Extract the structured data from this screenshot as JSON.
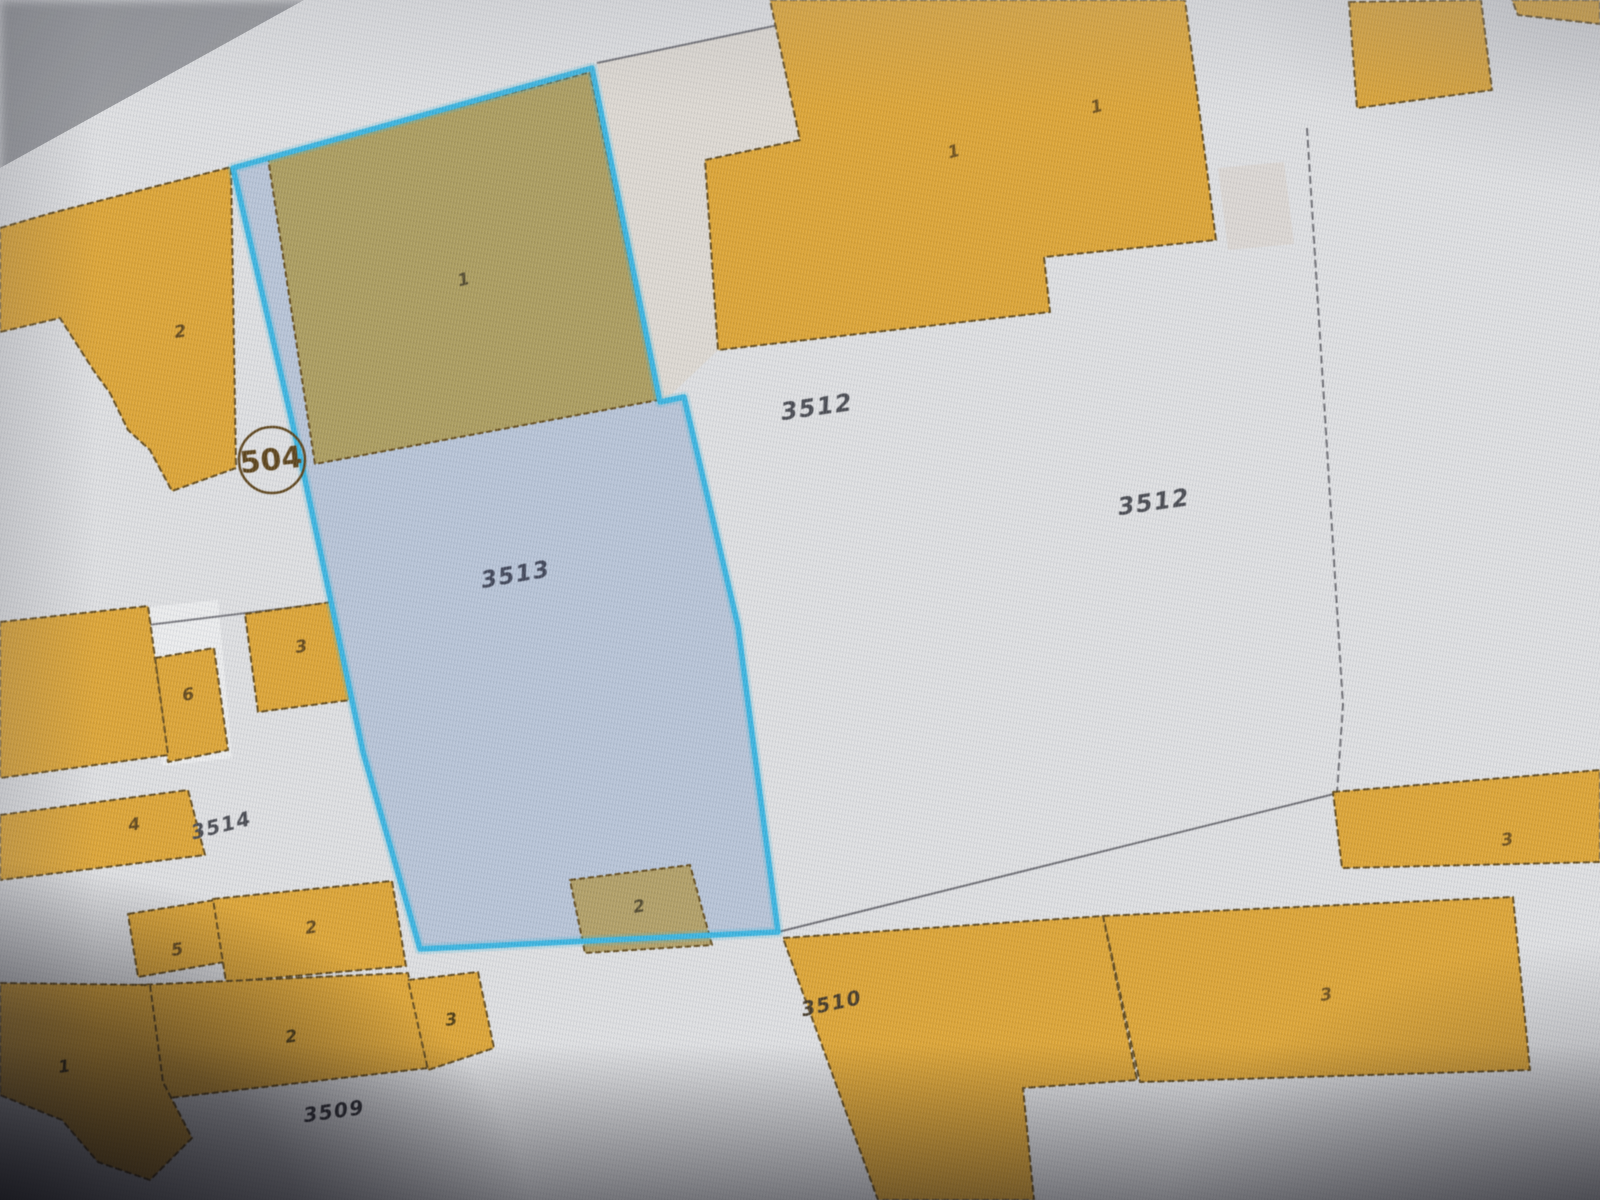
{
  "app": {
    "title": "Cadastral parcel map view",
    "selected_parcel_id": "3513"
  },
  "colors": {
    "screen_background": "#dedfe1",
    "building_orange": "#e0a226",
    "building_outline_brown": "#5f4512",
    "selection_fill_blue": "#b2c1d7",
    "selection_outline_cyan": "#2db5e5",
    "olive_building_under_selection": "#ab9a55",
    "parcel_label_dark": "#43454c",
    "boundary_gray": "#6a6a70"
  },
  "map": {
    "width": 1600,
    "height": 1200,
    "background": "#dedfe1",
    "building_fill": "#e0a226",
    "building_stroke": "#5f4512",
    "regions": [
      {
        "name": "pale-strip-parcel",
        "fill": "#ddd8d0",
        "points": [
          [
            597,
            63
          ],
          [
            788,
            23
          ],
          [
            800,
            140
          ],
          [
            706,
            158
          ],
          [
            718,
            350
          ],
          [
            660,
            405
          ],
          [
            628,
            230
          ]
        ]
      },
      {
        "name": "light-path-strip",
        "fill": "rgba(245,245,248,0.55)",
        "points": [
          [
            148,
            607
          ],
          [
            218,
            600
          ],
          [
            232,
            758
          ],
          [
            162,
            766
          ]
        ]
      },
      {
        "name": "beige-smudge",
        "fill": "rgba(214,205,194,0.45)",
        "points": [
          [
            1218,
            168
          ],
          [
            1284,
            162
          ],
          [
            1294,
            244
          ],
          [
            1228,
            250
          ]
        ]
      }
    ],
    "boundaries": [
      {
        "name": "boundary-strip-top",
        "stroke": "#6a6a70",
        "width": 2,
        "points": [
          [
            597,
            63
          ],
          [
            788,
            23
          ]
        ]
      },
      {
        "name": "boundary-right-vertical",
        "stroke": "#6a6a70",
        "width": 2,
        "dash": "8 4",
        "points": [
          [
            1307,
            128
          ],
          [
            1343,
            705
          ],
          [
            1337,
            793
          ]
        ]
      },
      {
        "name": "boundary-3512-south",
        "stroke": "#6a6a70",
        "width": 2,
        "points": [
          [
            778,
            932
          ],
          [
            1338,
            793
          ]
        ]
      },
      {
        "name": "boundary-west-horizontal",
        "stroke": "#74747a",
        "width": 2,
        "points": [
          [
            0,
            643
          ],
          [
            345,
            601
          ]
        ]
      }
    ],
    "buildings": [
      {
        "name": "building-top-left-2",
        "points": [
          [
            0,
            228
          ],
          [
            48,
            214
          ],
          [
            231,
            167
          ],
          [
            236,
            468
          ],
          [
            172,
            491
          ],
          [
            150,
            450
          ],
          [
            128,
            430
          ],
          [
            110,
            393
          ],
          [
            94,
            371
          ],
          [
            60,
            318
          ],
          [
            0,
            332
          ]
        ]
      },
      {
        "name": "building-top-right-1",
        "points": [
          [
            770,
            0
          ],
          [
            1185,
            0
          ],
          [
            1216,
            240
          ],
          [
            1044,
            257
          ],
          [
            1050,
            312
          ],
          [
            718,
            350
          ],
          [
            705,
            160
          ],
          [
            800,
            140
          ]
        ]
      },
      {
        "name": "building-top-corner",
        "points": [
          [
            1349,
            2
          ],
          [
            1481,
            0
          ],
          [
            1492,
            90
          ],
          [
            1357,
            108
          ]
        ]
      },
      {
        "name": "building-top-corner-edge",
        "points": [
          [
            1512,
            0
          ],
          [
            1600,
            0
          ],
          [
            1600,
            24
          ],
          [
            1518,
            15
          ]
        ]
      },
      {
        "name": "building-right-3",
        "points": [
          [
            1333,
            792
          ],
          [
            1600,
            770
          ],
          [
            1600,
            862
          ],
          [
            1342,
            868
          ]
        ]
      },
      {
        "name": "building-bottom-right-3",
        "points": [
          [
            1103,
            916
          ],
          [
            1513,
            897
          ],
          [
            1530,
            1070
          ],
          [
            1140,
            1082
          ]
        ]
      },
      {
        "name": "building-3510",
        "points": [
          [
            783,
            938
          ],
          [
            1103,
            916
          ],
          [
            1137,
            1080
          ],
          [
            1023,
            1088
          ],
          [
            1034,
            1200
          ],
          [
            878,
            1200
          ]
        ]
      },
      {
        "name": "building-small-6",
        "points": [
          [
            155,
            658
          ],
          [
            214,
            648
          ],
          [
            228,
            750
          ],
          [
            168,
            762
          ]
        ]
      },
      {
        "name": "building-small-3",
        "points": [
          [
            245,
            614
          ],
          [
            332,
            602
          ],
          [
            350,
            700
          ],
          [
            258,
            712
          ]
        ]
      },
      {
        "name": "building-west-large",
        "points": [
          [
            0,
            622
          ],
          [
            148,
            606
          ],
          [
            168,
            755
          ],
          [
            0,
            778
          ]
        ]
      },
      {
        "name": "building-4",
        "points": [
          [
            0,
            815
          ],
          [
            188,
            790
          ],
          [
            205,
            855
          ],
          [
            0,
            880
          ]
        ]
      },
      {
        "name": "building-5",
        "points": [
          [
            128,
            914
          ],
          [
            215,
            900
          ],
          [
            224,
            962
          ],
          [
            138,
            977
          ]
        ]
      },
      {
        "name": "building-row-2",
        "points": [
          [
            213,
            899
          ],
          [
            392,
            881
          ],
          [
            406,
            966
          ],
          [
            226,
            982
          ]
        ]
      },
      {
        "name": "building-bottom-2",
        "points": [
          [
            116,
            986
          ],
          [
            408,
            973
          ],
          [
            428,
            1068
          ],
          [
            134,
            1102
          ]
        ]
      },
      {
        "name": "building-bottom-3",
        "points": [
          [
            408,
            980
          ],
          [
            478,
            972
          ],
          [
            494,
            1048
          ],
          [
            428,
            1070
          ]
        ]
      },
      {
        "name": "building-corner-1",
        "points": [
          [
            0,
            983
          ],
          [
            150,
            985
          ],
          [
            163,
            1082
          ],
          [
            192,
            1138
          ],
          [
            150,
            1180
          ],
          [
            98,
            1162
          ],
          [
            62,
            1120
          ],
          [
            0,
            1095
          ]
        ]
      }
    ],
    "selected_parcel": {
      "id": "3513",
      "fill": "#b2c1d7",
      "stroke": "#2db5e5",
      "points": [
        [
          233,
          168
        ],
        [
          592,
          68
        ],
        [
          660,
          402
        ],
        [
          684,
          397
        ],
        [
          738,
          626
        ],
        [
          778,
          932
        ],
        [
          420,
          949
        ],
        [
          363,
          752
        ],
        [
          300,
          456
        ]
      ],
      "inner_buildings": [
        {
          "name": "building-olive-1",
          "fill": "#ab9a55",
          "points": [
            [
              268,
              158
            ],
            [
              590,
              72
            ],
            [
              658,
              400
            ],
            [
              315,
              464
            ]
          ]
        },
        {
          "name": "building-olive-2",
          "fill": "#b19d5e",
          "points": [
            [
              570,
              880
            ],
            [
              690,
              865
            ],
            [
              712,
              945
            ],
            [
              585,
              953
            ]
          ]
        }
      ]
    },
    "parcel_labels": [
      {
        "text": "3512",
        "x": 818,
        "y": 415,
        "rot": -8,
        "size": 24,
        "color": "#43454c"
      },
      {
        "text": "3512",
        "x": 1155,
        "y": 510,
        "rot": -8,
        "size": 24,
        "color": "#43454c"
      },
      {
        "text": "3513",
        "x": 517,
        "y": 582,
        "rot": -10,
        "size": 23,
        "color": "#3a4054"
      },
      {
        "text": "3514",
        "x": 223,
        "y": 832,
        "rot": -14,
        "size": 20,
        "color": "#43454c"
      },
      {
        "text": "3510",
        "x": 833,
        "y": 1010,
        "rot": -12,
        "size": 20,
        "color": "#3f3320"
      },
      {
        "text": "3509",
        "x": 335,
        "y": 1118,
        "rot": -8,
        "size": 20,
        "color": "#26262c"
      }
    ],
    "building_numbers": [
      {
        "text": "2",
        "x": 181,
        "y": 337,
        "rot": -8,
        "color": "#5f4210"
      },
      {
        "text": "1",
        "x": 465,
        "y": 285,
        "rot": -14,
        "color": "#4f4526"
      },
      {
        "text": "1",
        "x": 955,
        "y": 157,
        "rot": -14,
        "color": "#6b4a10"
      },
      {
        "text": "1",
        "x": 1098,
        "y": 112,
        "rot": -14,
        "color": "#6b4a10"
      },
      {
        "text": "3",
        "x": 302,
        "y": 652,
        "rot": -8,
        "color": "#5f4210"
      },
      {
        "text": "6",
        "x": 189,
        "y": 700,
        "rot": -8,
        "color": "#5f4210"
      },
      {
        "text": "4",
        "x": 135,
        "y": 830,
        "rot": -8,
        "color": "#5f4210"
      },
      {
        "text": "5",
        "x": 178,
        "y": 955,
        "rot": -8,
        "color": "#5f4210"
      },
      {
        "text": "2",
        "x": 312,
        "y": 933,
        "rot": -8,
        "color": "#5f4210"
      },
      {
        "text": "2",
        "x": 292,
        "y": 1042,
        "rot": -8,
        "color": "#4a3608"
      },
      {
        "text": "3",
        "x": 452,
        "y": 1025,
        "rot": -8,
        "color": "#4a3608"
      },
      {
        "text": "1",
        "x": 65,
        "y": 1072,
        "rot": -8,
        "color": "#3a2a06"
      },
      {
        "text": "2",
        "x": 640,
        "y": 912,
        "rot": -10,
        "color": "#4f4526"
      },
      {
        "text": "3",
        "x": 1508,
        "y": 845,
        "rot": -8,
        "color": "#6b4a10"
      },
      {
        "text": "3",
        "x": 1327,
        "y": 1000,
        "rot": -8,
        "color": "#6b4a10"
      }
    ],
    "control_point": {
      "text": "504",
      "x": 272,
      "y": 460,
      "r": 33,
      "rot": -6,
      "size": 30,
      "color": "#5a3e10"
    }
  }
}
